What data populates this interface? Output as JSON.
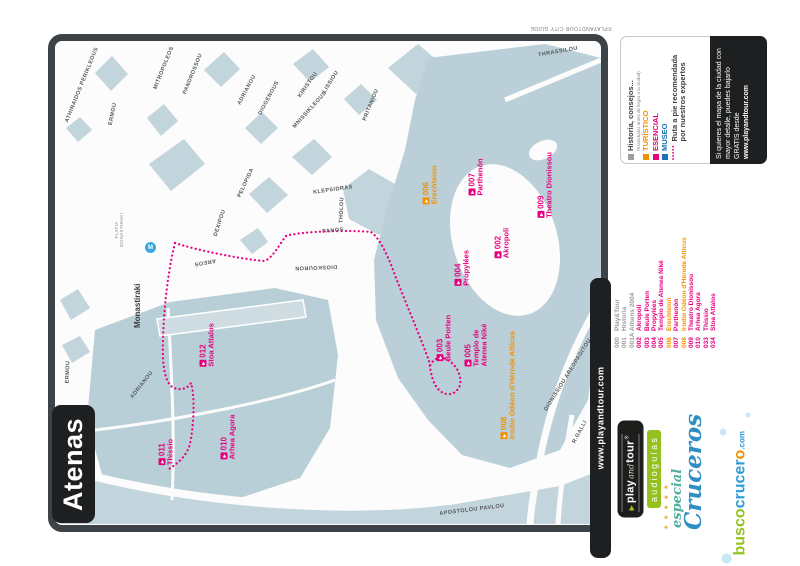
{
  "page": {
    "title_box": "Atenas"
  },
  "colors": {
    "pink": "#e6007e",
    "orange": "#f39200",
    "blue": "#1d70b7",
    "gray": "#9d9d9c",
    "dark": "#3d3d3b",
    "green": "#95c11f",
    "block": "#c2d4dc",
    "metro": "#36a9e1"
  },
  "map": {
    "copyright": "©PLAYANDTOUR CITY GUIDE",
    "side_tab": "www.playandtour.com",
    "metro": {
      "symbol": "M",
      "name": "Monastiraki",
      "square_label": "PLATIA\nMONASTIRAKI"
    },
    "streets": [
      {
        "name": "ATHINAIDOS PERIKLEOUS",
        "x": 82,
        "y": 85,
        "rot": -68
      },
      {
        "name": "ERMOU",
        "x": 113,
        "y": 114,
        "rot": -78
      },
      {
        "name": "MITROPOLEOS",
        "x": 164,
        "y": 68,
        "rot": -68
      },
      {
        "name": "PANDROSSOU",
        "x": 193,
        "y": 74,
        "rot": -68
      },
      {
        "name": "ADRIANOU",
        "x": 247,
        "y": 90,
        "rot": -62
      },
      {
        "name": "DIOGENOUS",
        "x": 269,
        "y": 98,
        "rot": -62
      },
      {
        "name": "KIRISTOU",
        "x": 308,
        "y": 85,
        "rot": -55
      },
      {
        "name": "LISSIOU",
        "x": 331,
        "y": 82,
        "rot": -58
      },
      {
        "name": "MNISSIKLEOUS",
        "x": 310,
        "y": 110,
        "rot": -48
      },
      {
        "name": "PRITANIOU",
        "x": 371,
        "y": 105,
        "rot": -68
      },
      {
        "name": "THRASSILOU",
        "x": 558,
        "y": 52,
        "rot": -10
      },
      {
        "name": "KLEPSIDRAS",
        "x": 333,
        "y": 190,
        "rot": -8
      },
      {
        "name": "THOLOU",
        "x": 342,
        "y": 210,
        "rot": -88
      },
      {
        "name": "PANOS",
        "x": 333,
        "y": 231,
        "rot": -5
      },
      {
        "name": "DIOSKOURON",
        "x": 316,
        "y": 267,
        "rot": 178
      },
      {
        "name": "DEXIPOU",
        "x": 220,
        "y": 223,
        "rot": -72
      },
      {
        "name": "AREOS",
        "x": 205,
        "y": 262,
        "rot": 170
      },
      {
        "name": "PELOPIDA",
        "x": 246,
        "y": 183,
        "rot": -65
      },
      {
        "name": "ADRIANOU",
        "x": 142,
        "y": 385,
        "rot": -52
      },
      {
        "name": "ERMOU",
        "x": 68,
        "y": 372,
        "rot": -88
      },
      {
        "name": "APOSTOLOU PAVLOU",
        "x": 472,
        "y": 510,
        "rot": -7
      },
      {
        "name": "DIONISSIOU AREOPAGITOU",
        "x": 568,
        "y": 375,
        "rot": -58
      },
      {
        "name": "R.GALLI",
        "x": 580,
        "y": 432,
        "rot": -62
      }
    ],
    "pois": [
      {
        "num": "006",
        "name": "Erechteion",
        "color": "orange",
        "x": 430,
        "y": 185
      },
      {
        "num": "007",
        "name": "Parthenón",
        "color": "pink",
        "x": 476,
        "y": 177
      },
      {
        "num": "009",
        "name": "Theatro Dionissou",
        "color": "pink",
        "x": 545,
        "y": 185
      },
      {
        "num": "002",
        "name": "Akropoli",
        "color": "pink",
        "x": 502,
        "y": 243
      },
      {
        "num": "004",
        "name": "Propylées",
        "color": "pink",
        "x": 462,
        "y": 268
      },
      {
        "num": "003",
        "name": "Beule Porten",
        "color": "pink",
        "x": 444,
        "y": 338
      },
      {
        "num": "005",
        "name": "Templo de\nAtenea Niké",
        "color": "pink",
        "x": 476,
        "y": 345
      },
      {
        "num": "008",
        "name": "Irodio Odéon d'Hérode Atticus",
        "color": "orange",
        "x": 508,
        "y": 385
      },
      {
        "num": "012",
        "name": "Stoa Attalos",
        "color": "pink",
        "x": 207,
        "y": 345
      },
      {
        "num": "010",
        "name": "Arhea Agora",
        "color": "pink",
        "x": 228,
        "y": 437
      },
      {
        "num": "011",
        "name": "Thissio",
        "color": "pink",
        "x": 166,
        "y": 452
      }
    ]
  },
  "legend": {
    "items": [
      {
        "swatch": "#9d9d9c",
        "label": "Historia, consejos...",
        "sub": "(Escúchalos antes de llegar a la ciudad)",
        "color": "#3d3d3b"
      },
      {
        "swatch": "#f39200",
        "label": "TURÍSTICO",
        "color": "#f39200"
      },
      {
        "swatch": "#e6007e",
        "label": "ESENCIAL",
        "color": "#e6007e"
      },
      {
        "swatch": "#1d70b7",
        "label": "MUSEO",
        "color": "#1d70b7"
      },
      {
        "swatch": "dots",
        "label": "Ruta a pie recomendada\npor nuestros expertos",
        "color": "#3d3d3b"
      }
    ]
  },
  "promo": {
    "text": "Si quieres el mapa de la ciudad con mayor detalle, puedes bajarlo GRATIS desde ",
    "url": "www.playandtour.com"
  },
  "poi_list": [
    {
      "num": "000",
      "label": "Play&Tour",
      "type": "gray"
    },
    {
      "num": "001",
      "label": "Historia",
      "type": "gray"
    },
    {
      "num": "001A",
      "label": "Athens 2004",
      "type": "gray"
    },
    {
      "num": "002",
      "label": "Akropoli",
      "type": "pink"
    },
    {
      "num": "003",
      "label": "Beule Porten",
      "type": "pink"
    },
    {
      "num": "004",
      "label": "Propylées",
      "type": "pink"
    },
    {
      "num": "005",
      "label": "Templo de Atenea Niké",
      "type": "pink"
    },
    {
      "num": "006",
      "label": "Erechteion",
      "type": "orange"
    },
    {
      "num": "007",
      "label": "Parthenón",
      "type": "pink"
    },
    {
      "num": "008",
      "label": "Irodio Odéon d'Hérode Atticus",
      "type": "orange"
    },
    {
      "num": "009",
      "label": "Theatro Dionissou",
      "type": "pink"
    },
    {
      "num": "010",
      "label": "Arhea Agora",
      "type": "pink"
    },
    {
      "num": "033",
      "label": "Thissio",
      "type": "pink"
    },
    {
      "num": "034",
      "label": "Stoa Attalos",
      "type": "pink"
    }
  ],
  "logos": {
    "play_tri": "▶",
    "play": "play",
    "and": "and",
    "tour": "tour",
    "reg": "®",
    "audioguias": "audioguías",
    "stars": "★ ★ ★ ★ ★",
    "especial": "especial",
    "cruceros": "Cruceros",
    "busco": "busco",
    "crucer": "crucer",
    "o": "o",
    "dotcom": ".com"
  }
}
